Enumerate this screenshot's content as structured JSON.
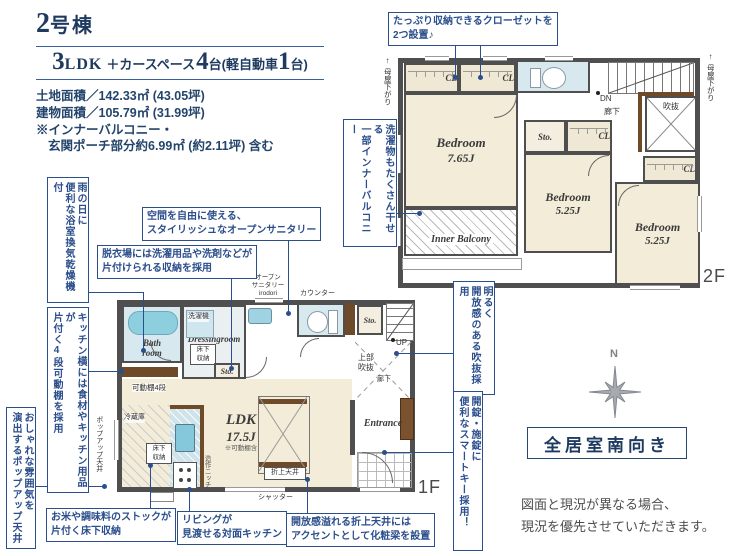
{
  "header": {
    "building_parts": [
      "2",
      "号棟"
    ],
    "spec_parts": [
      "3",
      "LDK",
      "＋カースペース",
      "4",
      "台(軽自動車",
      "1",
      "台)"
    ],
    "land_area": "土地面積／142.33㎡ (43.05坪)",
    "building_area": "建物面積／105.79㎡ (31.99坪)",
    "note_line1": "※インナーバルコニー・",
    "note_line2": "玄関ポーチ部分約6.99㎡ (約2.11坪) 含む"
  },
  "callouts": {
    "closet": "たっぷり収納できるクローゼットを\n2つ設置♪",
    "inner_balcony": "洗濯物もたくさん干せる\n一部インナーバルコニー",
    "bath_dryer": "雨の日に\n便利な浴室換気乾燥機付",
    "kitchen_shelf": "キッチン横には食材やキッチン用品が\n片付く4段可動棚を採用",
    "popup_ceiling": "おしゃれな雰囲気を\n演出するポップアップ天井",
    "open_sanitary": "空間を自由に使える、\nスタイリッシュなオープンサニタリー",
    "laundry_storage": "脱衣場には洗濯用品や洗剤などが\n片付けられる収納を採用",
    "void_light": "明るく\n開放感のある吹抜採用",
    "smart_key": "開錠・施錠に\n便利なスマートキー採用！",
    "rice_storage": "お米や調味料のストックが\n片付く床下収納",
    "counter_kitchen": "リビングが\n見渡せる対面キッチン",
    "ceiling_beam": "開放感溢れる折上天井には\nアクセントとして化粧梁を設置"
  },
  "floor2": {
    "label": "2F",
    "bedroom1_name": "Bedroom",
    "bedroom1_size": "7.65J",
    "bedroom2_name": "Bedroom",
    "bedroom2_size": "5.25J",
    "bedroom3_name": "Bedroom",
    "bedroom3_size": "5.25J",
    "inner_balcony": "Inner Balcony",
    "cl": "CL",
    "sto": "Sto.",
    "void": "吹抜",
    "hallway": "廊下",
    "dn": "DN",
    "eaves_arrow": "↑",
    "eaves": "母屋下がり"
  },
  "floor1": {
    "label": "1F",
    "bath": "Bath\nroom",
    "washer": "洗濯機",
    "dressing": "Dressingroom",
    "underfloor": "床下\n収納",
    "sto": "Sto.",
    "shelf": "可動棚4段",
    "fridge": "冷蔵庫",
    "ldk": "LDK",
    "ldk_size": "17.5J",
    "ldk_note": "※可動棚含",
    "coffered": "折上天井",
    "shutter": "シャッター",
    "counter": "カウンター",
    "up": "UP",
    "upper_void": "上部\n吹抜",
    "hallway": "廊下",
    "entrance": "Entrance",
    "sanitary": "オープン\nサニタリー\nirodori",
    "niche": "造作ニッチ",
    "popup_ceiling": "ポップアップ天井"
  },
  "compass": {
    "north": "N"
  },
  "south_badge": "全居室南向き",
  "disclaimer": "図面と現況が異なる場合、\n現況を優先させていただきます。",
  "colors": {
    "navy": "#1e3a5f",
    "callout_blue": "#2b4e8c",
    "wall": "#4f4f4f",
    "room_cream": "#f2ecd8",
    "water_blue": "#d8e8ef",
    "wood_brown": "#6e4a28"
  }
}
